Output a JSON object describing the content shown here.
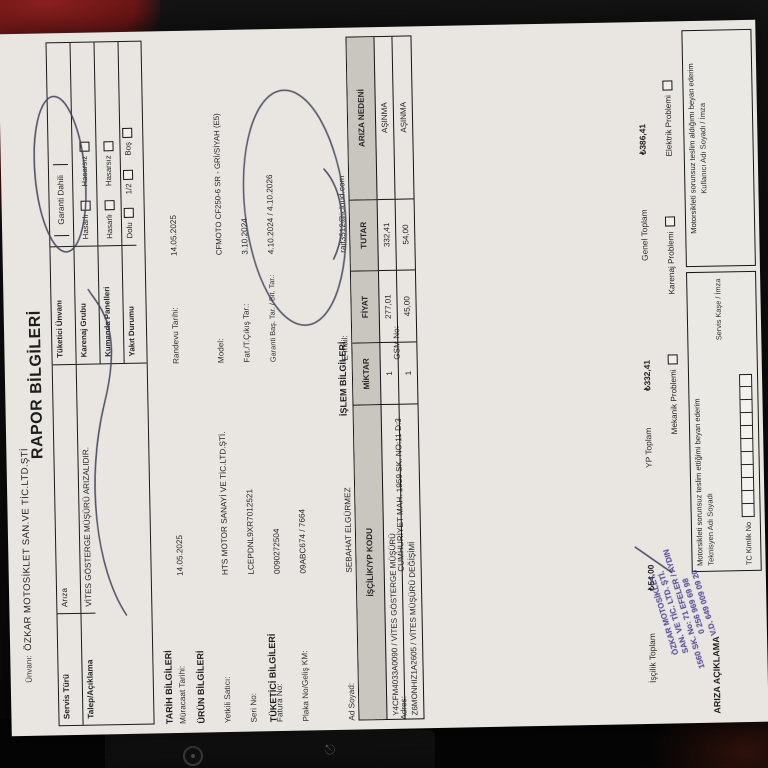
{
  "header": {
    "unvani_label": "Ünvanı:",
    "company": "ÖZKAR MOTOSİKLET SAN.VE TİC.LTD.ŞTİ",
    "title": "RAPOR BİLGİLERİ"
  },
  "top_box": {
    "left_rows": [
      {
        "label": "Servis Türü",
        "value": "Arıza"
      },
      {
        "label": "Talep/Açıklama",
        "value": "VİTES GÖSTERGE MÜŞÜRÜ ARIZALIDIR."
      }
    ],
    "right_rows": [
      {
        "label": "Tüketici Ünvanı",
        "value": "Garanti Dahili"
      },
      {
        "label": "Karenaj Grubu",
        "options": [
          "Hasarlı",
          "Hasarsız"
        ]
      },
      {
        "label": "Kumanda Panelleri",
        "options": [
          "Hasarlı",
          "Hasarsız"
        ]
      },
      {
        "label": "Yakıt Durumu",
        "options": [
          "Dolu",
          "1/2",
          "Boş"
        ]
      }
    ]
  },
  "tarih": {
    "title": "TARİH BİLGİLERİ",
    "rows": [
      {
        "label": "Müracaat Tarihi:",
        "value": "14.05.2025"
      },
      {
        "label": "Randevu Tarihi:",
        "value": "14.05.2025"
      }
    ]
  },
  "urun": {
    "title": "ÜRÜN BİLGİLERİ",
    "left": [
      {
        "label": "Yetkili Satıcı:",
        "value": "HTS MOTOR SANAYİ VE TİC.LTD.ŞTİ."
      },
      {
        "label": "Seri No:",
        "value": "LCEPDNL9XR7012521"
      },
      {
        "label": "Fatura No:",
        "value": "0090272504"
      },
      {
        "label": "Plaka No/Geliş KM:",
        "value": "09ABC674 / 7664"
      }
    ],
    "right": [
      {
        "label": "Model:",
        "value": "CFMOTO CF250-6 SR - GRİ/SİYAH (E5)"
      },
      {
        "label": "Fat./T.Çıkış Tar.:",
        "value": "3.10.2024"
      },
      {
        "label": "Garanti Baş. Tar. / Bit. Tar.:",
        "value": "4.10.2024 / 4.10.2026"
      }
    ]
  },
  "tuketici": {
    "title": "TÜKETİCİ BİLGİLERİ",
    "left": [
      {
        "label": "Ad Soyad:",
        "value": "SEBAHAT ELGÜRMEZ"
      },
      {
        "label": "Şehir/İlçe-Semt:",
        "value": "AYDIN/AYDIN MERKEZ"
      },
      {
        "label": "Adres:",
        "value": "CUMHURİYET MAH. 1959 SK. NO:11 D:3"
      }
    ],
    "right": [
      {
        "label": "E-mail:",
        "value": "raif3512@icloud.com"
      },
      {
        "label": "Telefon No:",
        "value": "(551) 596-0904"
      },
      {
        "label": "GSM No:",
        "value": ""
      }
    ]
  },
  "islem": {
    "title": "İŞLEM BİLGİLERİ",
    "columns": [
      "İŞÇİLİK/YP KODU",
      "MİKTAR",
      "FİYAT",
      "TUTAR",
      "ARIZA NEDENİ"
    ],
    "rows": [
      [
        "Y4CFM4033A0090 / VİTES GÖSTERGE MÜŞÜRÜ",
        "1",
        "277,01",
        "332,41",
        "AŞINMA"
      ],
      [
        "Z6MONHIZ1A2605 / VİTES MÜŞÜRÜ DEĞİŞİMİ",
        "1",
        "45,00",
        "54,00",
        "AŞINMA"
      ]
    ],
    "totals": [
      {
        "label": "İşçilik Toplam",
        "value": "₺54,00"
      },
      {
        "label": "YP Toplam",
        "value": "₺332,41"
      },
      {
        "label": "Genel Toplam",
        "value": "₺386,41"
      }
    ],
    "problems": [
      "Mekanik Problemi",
      "Karenaj Problemi",
      "Elektrik Problemi"
    ]
  },
  "footer": {
    "ariza_aciklama": "ARIZA AÇIKLAMA",
    "left_box": {
      "line1": "Motorsikleti sorunsuz teslim ettiğimi beyan ederim",
      "line2": "Teknisyen Adı Soyadı",
      "line3": "TC Kimlik No",
      "line4": "Servis Kaşe / İmza"
    },
    "right_box": {
      "line1": "Motorsikleti sorunsuz teslim aldığımı beyan ederim",
      "line2": "Kullanıcı Adı Soyadı / İmza"
    },
    "stamp_lines": [
      "ÖZKAR MOTOSİKLET",
      "SAN. VE TİC. LTD. ŞTİ.",
      "1560 SK. No: 71 EFELER / AYDIN",
      "0 256 969 69 98",
      "V.D. 649 009 09 20"
    ]
  }
}
